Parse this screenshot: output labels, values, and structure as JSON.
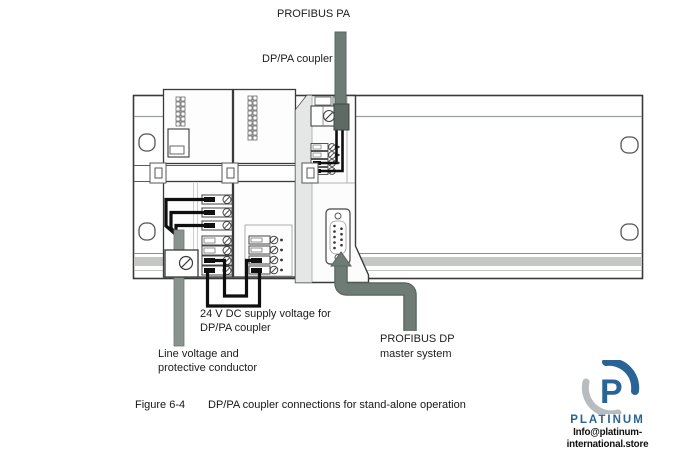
{
  "figure": {
    "labels": {
      "profibus_pa": "PROFIBUS PA",
      "dppa_coupler": "DP/PA coupler",
      "supply_line1": "24 V DC supply voltage for",
      "supply_line2": "DP/PA coupler",
      "line_voltage_line1": "Line voltage and",
      "line_voltage_line2": "protective conductor",
      "profibus_dp_line1": "PROFIBUS DP",
      "profibus_dp_line2": "master system"
    },
    "caption": {
      "number": "Figure 6-4",
      "text": "DP/PA coupler connections for stand-alone operation"
    }
  },
  "watermark": {
    "monogram": "P",
    "brand": "PLATINUM",
    "email": "Info@platinum-international.store"
  },
  "colors": {
    "profibus_pipe": "#6f7b75",
    "line_voltage_cable": "#8a948f",
    "rail_band": "#c3c8c5",
    "wire_black": "#0f0f0f",
    "logo_blue": "#2a6496",
    "logo_gray": "#b7bcbe"
  }
}
